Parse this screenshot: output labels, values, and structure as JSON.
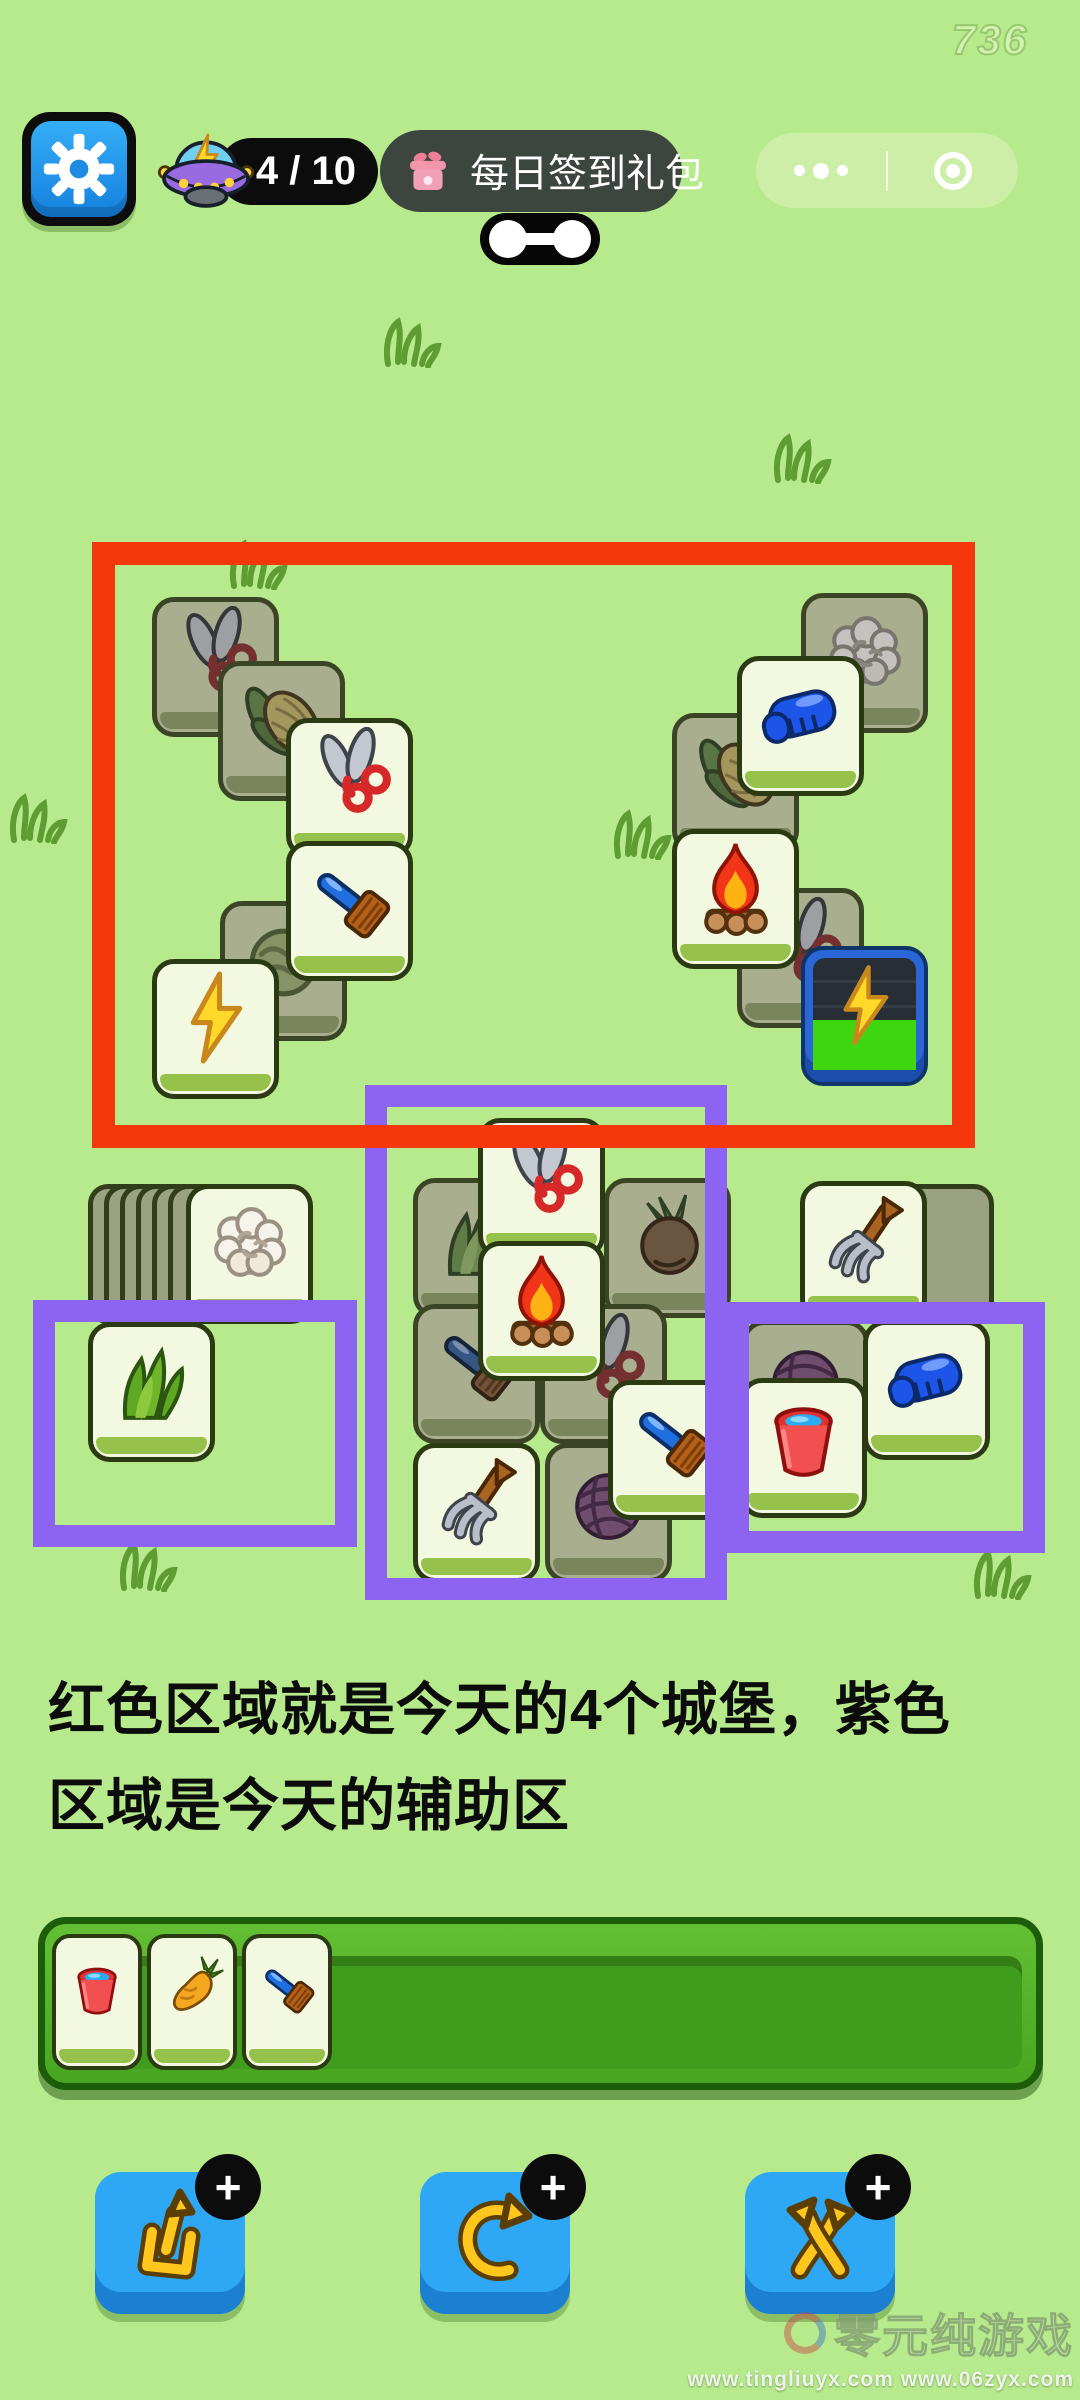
{
  "hud": {
    "fps": "736",
    "counter": "4 / 10",
    "signin_label": "每日签到礼包"
  },
  "caption": {
    "line1": "红色区域就是今天的4个城堡，紫色",
    "line2": "区域是今天的辅助区"
  },
  "colors": {
    "background": "#b7ea8c",
    "red_box": "#f5380c",
    "purple_box": "#8d64f2",
    "tile_face": "#f3f8e0",
    "tile_dim": "#a8ae8e",
    "button_blue": "#2ea7f4"
  },
  "board": {
    "stacks": [
      {
        "x": 88,
        "y": 1184,
        "count": 6,
        "step": 16,
        "w": 96,
        "h": 140
      },
      {
        "x": 838,
        "y": 1184,
        "count": 5,
        "step": 16,
        "w": 92,
        "h": 138
      }
    ],
    "tiles": [
      {
        "icon": "scissors",
        "x": 152,
        "y": 597,
        "dim": true
      },
      {
        "icon": "corn",
        "x": 218,
        "y": 661,
        "dim": true
      },
      {
        "icon": "scissors",
        "x": 286,
        "y": 718,
        "dim": false
      },
      {
        "icon": "lettuce",
        "x": 220,
        "y": 901,
        "dim": true
      },
      {
        "icon": "brush",
        "x": 286,
        "y": 841,
        "dim": false
      },
      {
        "icon": "bolt",
        "x": 152,
        "y": 959,
        "dim": false
      },
      {
        "icon": "cotton",
        "x": 801,
        "y": 593,
        "dim": true
      },
      {
        "icon": "corn",
        "x": 672,
        "y": 713,
        "dim": true
      },
      {
        "icon": "glove",
        "x": 737,
        "y": 656,
        "dim": false
      },
      {
        "icon": "scissors",
        "x": 737,
        "y": 888,
        "dim": true
      },
      {
        "icon": "fire",
        "x": 672,
        "y": 829,
        "dim": false
      },
      {
        "icon": "bolt",
        "x": 801,
        "y": 946,
        "dim": false,
        "special": true
      },
      {
        "icon": "cotton",
        "x": 186,
        "y": 1184,
        "dim": false
      },
      {
        "icon": "grass",
        "x": 88,
        "y": 1322,
        "dim": false
      },
      {
        "icon": "pitchfork",
        "x": 800,
        "y": 1181,
        "dim": false
      },
      {
        "icon": "grass",
        "x": 413,
        "y": 1178,
        "dim": true
      },
      {
        "icon": "turnip",
        "x": 604,
        "y": 1178,
        "dim": true
      },
      {
        "icon": "scissors",
        "x": 478,
        "y": 1118,
        "dim": false
      },
      {
        "icon": "brush",
        "x": 413,
        "y": 1304,
        "dim": true
      },
      {
        "icon": "scissors",
        "x": 540,
        "y": 1304,
        "dim": true
      },
      {
        "icon": "fire",
        "x": 478,
        "y": 1241,
        "dim": false
      },
      {
        "icon": "yarn",
        "x": 545,
        "y": 1443,
        "dim": true
      },
      {
        "icon": "pitchfork",
        "x": 413,
        "y": 1443,
        "dim": false
      },
      {
        "icon": "brush",
        "x": 608,
        "y": 1380,
        "dim": false
      },
      {
        "icon": "yarn",
        "x": 742,
        "y": 1320,
        "dim": true
      },
      {
        "icon": "glove",
        "x": 863,
        "y": 1320,
        "dim": false
      },
      {
        "icon": "bucket",
        "x": 740,
        "y": 1378,
        "dim": false
      }
    ],
    "annotations": [
      {
        "kind": "purple",
        "x": 33,
        "y": 1300,
        "w": 324,
        "h": 247
      },
      {
        "kind": "purple",
        "x": 365,
        "y": 1085,
        "w": 362,
        "h": 515
      },
      {
        "kind": "purple",
        "x": 727,
        "y": 1302,
        "w": 318,
        "h": 251
      },
      {
        "kind": "red",
        "x": 92,
        "y": 542,
        "w": 883,
        "h": 606
      }
    ],
    "doodles": [
      {
        "x": 228,
        "y": 538
      },
      {
        "x": 382,
        "y": 316
      },
      {
        "x": 772,
        "y": 432
      },
      {
        "x": 612,
        "y": 808
      },
      {
        "x": 8,
        "y": 792
      },
      {
        "x": 118,
        "y": 1540
      },
      {
        "x": 972,
        "y": 1548
      }
    ]
  },
  "tray": {
    "items": [
      "bucket",
      "carrot",
      "brush"
    ]
  },
  "powerups": [
    {
      "name": "remove-tile-button",
      "icon": "popout",
      "badge": "+"
    },
    {
      "name": "undo-button",
      "icon": "undo",
      "badge": "+"
    },
    {
      "name": "shuffle-button",
      "icon": "shuffle",
      "badge": "+"
    }
  ],
  "watermark": {
    "title": "零元纯游戏",
    "urls": "www.tingliuyx.com   www.06zyx.com"
  }
}
